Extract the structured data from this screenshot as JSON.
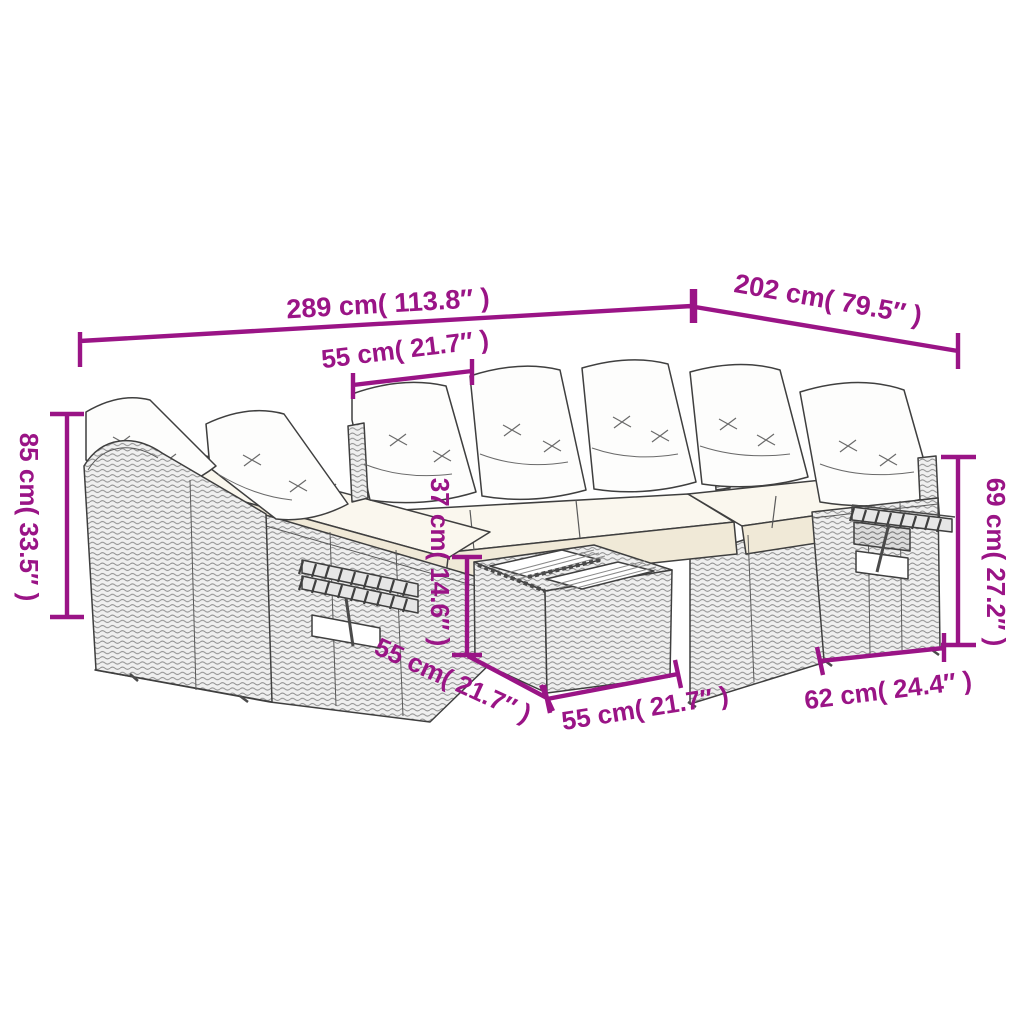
{
  "diagram": {
    "kind": "furniture-dimension-diagram",
    "subject": "U-shaped poly rattan garden lounge set with cushions and slatted table",
    "colors": {
      "dimension_accent": "#9a1486",
      "line_art_outline": "#3f3f3f",
      "wicker_fill": "#efefef",
      "cushion_white": "#fdfdfc",
      "seat_cream": "#f4eedd"
    },
    "labels": {
      "total_width": "289 cm( 113.8″ )",
      "total_depth": "202 cm( 79.5″ )",
      "seat_width": "55 cm( 21.7″ )",
      "total_height": "85 cm( 33.5″ )",
      "table_height": "37 cm( 14.6″ )",
      "armrest_height": "69 cm( 27.2″ )",
      "table_depth": "55 cm( 21.7″ )",
      "table_width": "55 cm( 21.7″ )",
      "seat_unit_depth": "62 cm( 24.4″ )"
    }
  }
}
